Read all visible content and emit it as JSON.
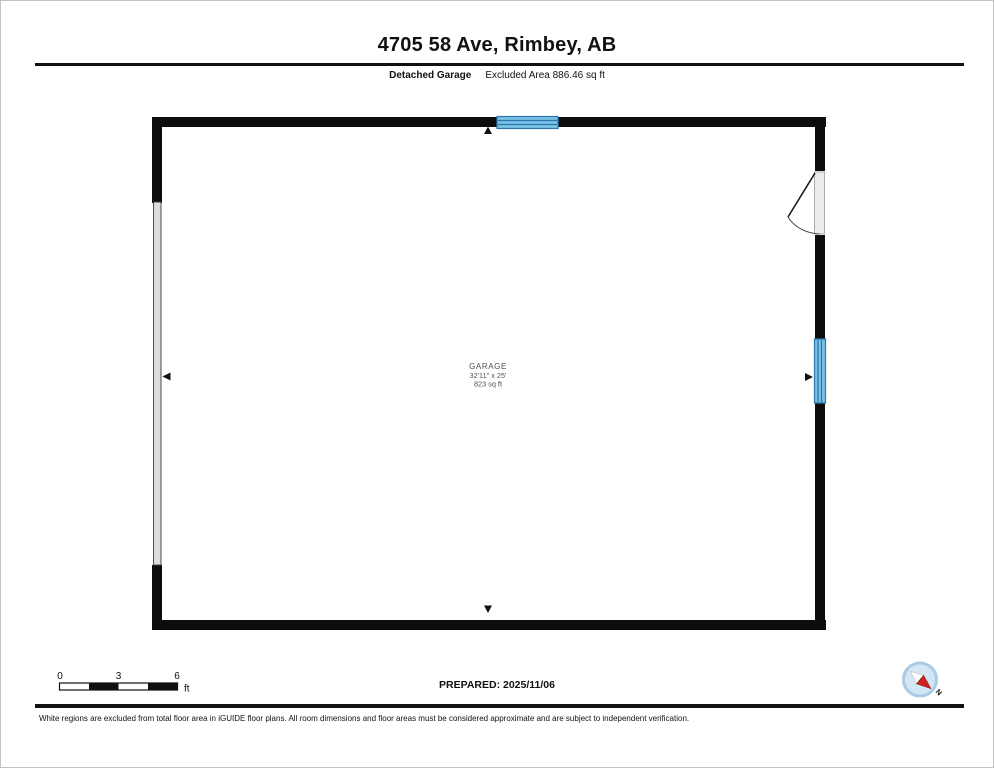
{
  "header": {
    "title": "4705 58 Ave, Rimbey, AB",
    "floor_label": "Detached Garage",
    "excluded_area": "Excluded Area 886.46 sq ft"
  },
  "plan": {
    "room": {
      "name": "GARAGE",
      "dimensions": "32'11\" x 25'",
      "area": "823 sq ft"
    }
  },
  "scale_bar": {
    "ticks": [
      "0",
      "3",
      "6"
    ],
    "unit": "ft"
  },
  "footer": {
    "prepared": "PREPARED: 2025/11/06",
    "disclaimer": "White regions are excluded from total floor area in iGUIDE floor plans. All room dimensions and floor areas must be considered approximate and are subject to independent verification."
  },
  "compass": {
    "label": "N"
  },
  "colors": {
    "wall": "#0d0d0d",
    "window_fill": "#7bc1e6",
    "window_stripe": "#2a77ae",
    "door_leaf": "#ececec",
    "garage_door_panel": "#dcdcdc",
    "compass_fill": "#d3e6f4",
    "compass_ring": "#aacbe6",
    "needle_red": "#cc2222",
    "label_gray": "#4f4f4f"
  }
}
